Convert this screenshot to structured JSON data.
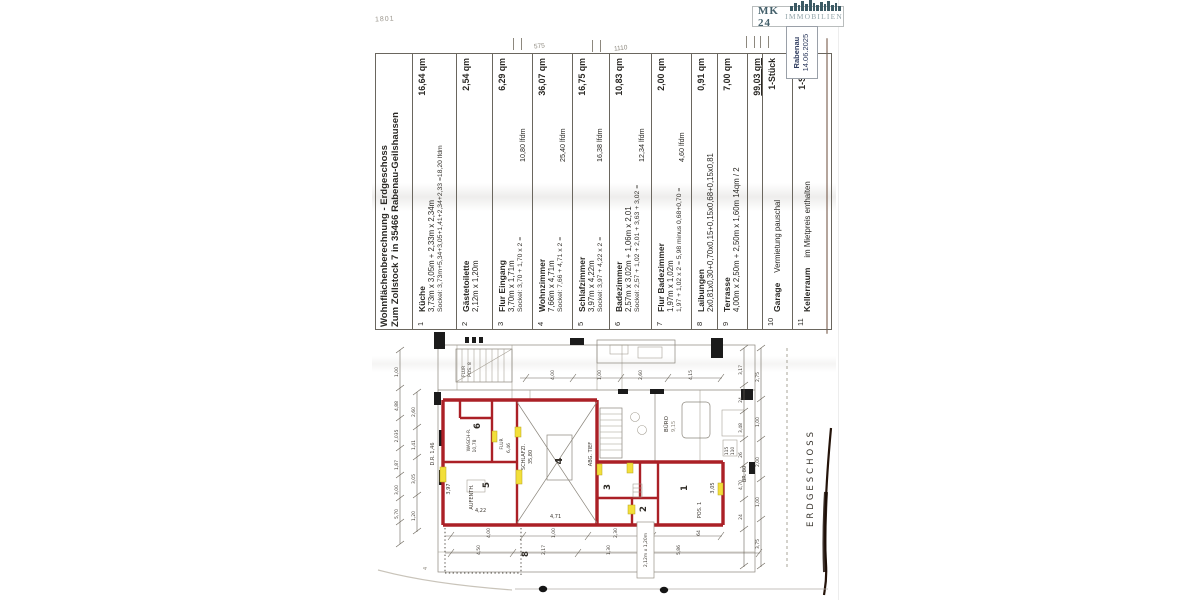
{
  "handwriting": {
    "top_left": "1801",
    "top_a": "575",
    "top_b": "1110",
    "corner": "4"
  },
  "logo": {
    "brand": "MK 24",
    "suffix": "IMMOBILIEN",
    "icon": "city-skyline-icon",
    "color_dark": "#44606b",
    "color_light": "#93a4a9"
  },
  "stamp": {
    "line1": "Rabenau",
    "line2": "14.06.2025"
  },
  "table": {
    "title_line1": "Wohnflächenberechnung - Erdgeschoss",
    "title_line2": "Zum Zollstock 7 in 35466 Rabenau-Geilshausen",
    "rows": [
      {
        "num": "1",
        "name": "Küche",
        "dims": "3,73m x 3,05m + 2,33m x 2,34m",
        "sockel": "Sockel: 3,73m+5,34+3,05+1,41+2,34+2,33 =18,20 lfdm",
        "lfdm": "",
        "qm": "16,64 qm"
      },
      {
        "num": "2",
        "name": "Gästetoilette",
        "dims": "2,12m x 1,20m",
        "sockel": "",
        "lfdm": "",
        "qm": "2,54 qm"
      },
      {
        "num": "3",
        "name": "Flur Eingang",
        "dims": "3,70m x 1,71m",
        "sockel": "Sockel: 3,70 + 1,70 x 2 =",
        "lfdm": "10,80 lfdm",
        "qm": "6,29 qm"
      },
      {
        "num": "4",
        "name": "Wohnzimmer",
        "dims": "7,66m x 4,71m",
        "sockel": "Sockel: 7,66 + 4,71 x 2 =",
        "lfdm": "25,40 lfdm",
        "qm": "36,07 qm"
      },
      {
        "num": "5",
        "name": "Schlafzimmer",
        "dims": "3,97m x 4,22m",
        "sockel": "Sockel: 3,97 + 4,22 x 2 =",
        "lfdm": "16,38 lfdm",
        "qm": "16,75 qm"
      },
      {
        "num": "6",
        "name": "Badezimmer",
        "dims": "2,57m x 3,02m + 1,06m x 2,01",
        "sockel": "Sockel: 2,57 + 1,02 + 2,01 + 3,63 + 3,02 =",
        "lfdm": "12,34 lfdm",
        "qm": "10,83 qm"
      },
      {
        "num": "7",
        "name": "Flur Badezimmer",
        "dims": "1,97m x 1,02m",
        "sockel": "1,97 + 1,02 x 2 = 5,98 minus 0,68+0,70 =",
        "lfdm": "4,60 lfdm",
        "qm": "2,00 qm"
      },
      {
        "num": "8",
        "name": "Laibungen",
        "dims": "2x0,81x0,30+0,70x0,15+0,15x0,68+0,15x0,81",
        "sockel": "",
        "lfdm": "",
        "qm": "0,91 qm"
      },
      {
        "num": "9",
        "name": "Terrasse",
        "dims": "4,00m x 2,50m + 2,50m x 1,60m  14qm / 2",
        "sockel": "",
        "lfdm": "",
        "qm": "7,00 qm"
      },
      {
        "num": "",
        "name": "",
        "dims": "",
        "sockel": "",
        "lfdm": "",
        "qm": "99,03 qm",
        "total": true
      },
      {
        "num": "10",
        "name": "Garage",
        "dims": "Vermietung pauschal",
        "sockel": "",
        "lfdm": "",
        "qm": "1-Stück",
        "inline": true
      },
      {
        "num": "11",
        "name": "Kellerraum",
        "dims": "im Mietpreis enthalten",
        "sockel": "",
        "lfdm": "",
        "qm": "1-Stück",
        "inline": true
      }
    ],
    "total_qm": "99,03 qm"
  },
  "plan": {
    "floor_label": "ERDGESCHOSS",
    "rooms": {
      "r1": "1",
      "r2": "2",
      "r3": "3",
      "r4": "4",
      "r5": "5",
      "r6": "6",
      "r8": "8"
    },
    "labels": {
      "flur_top": "FLUR",
      "pos8": "POS. 8",
      "wasch": "WASCH-R.",
      "wasch_area": "10,78",
      "flur": "FLUR",
      "flur_area": "6,46",
      "aufenth": "AUFENTH.",
      "schlafzi": "SCHLAFZI.",
      "schlafzi_area": "35,80",
      "abg": "ABG. TIEF",
      "buero": "BÜRO",
      "buero_area": "9,15",
      "pos1": "POS. 1",
      "dr": "D.R. 1,46",
      "br80": "BR. 80",
      "box115": "115",
      "box110": "110",
      "patch": "2,12m x 1,20m",
      "dim_471": "4,71",
      "dim_422": "4,22",
      "dim_397": "3,97",
      "dim_305": "3,05"
    },
    "dims_left1": [
      "1,00",
      "4,88",
      "2,035",
      "1,87",
      "3,00",
      "5,70"
    ],
    "dims_left2": [
      "2,60",
      "1,41",
      "3,05",
      "1,20"
    ],
    "dims_right1": [
      "3,17",
      "24",
      "3,48",
      "26",
      "4,70",
      "24"
    ],
    "dims_right2": [
      "2,75",
      "1,00",
      "2,00",
      "1,00",
      "3,75"
    ],
    "dims_top": [
      "4,00",
      "1,00",
      "2,60",
      "4,15"
    ],
    "dims_bottom1": [
      "4,00",
      "1,00",
      "2,30",
      "64"
    ],
    "dims_bottom2": [
      "4,50",
      "2,17",
      "1,30",
      "5,86"
    ]
  }
}
